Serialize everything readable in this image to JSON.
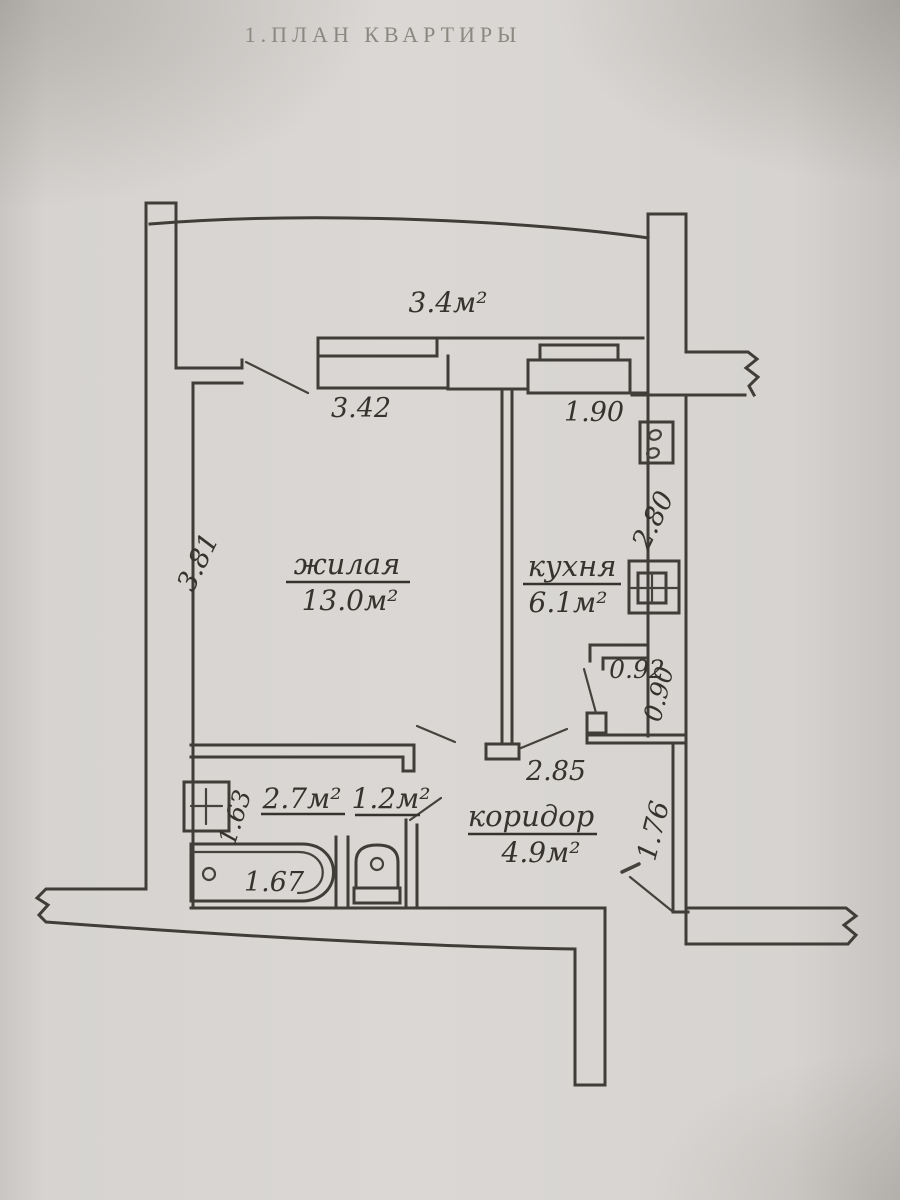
{
  "title": "1.ПЛАН КВАРТИРЫ",
  "balcony": {
    "area": "3.4м²"
  },
  "living": {
    "name": "жилая",
    "area": "13.0м²",
    "window_width": "3.42",
    "depth": "3.81"
  },
  "kitchen": {
    "name": "кухня",
    "area": "6.1м²",
    "window_width": "1.90",
    "depth": "2.80"
  },
  "corridor": {
    "name": "коридор",
    "area": "4.9м²",
    "length": "2.85",
    "entry_width": "1.76"
  },
  "bathroom": {
    "area": "2.7м²",
    "width": "1.63",
    "bath_length": "1.67"
  },
  "wc": {
    "area": "1.2м²"
  },
  "pantry": {
    "width": "0.92",
    "depth": "0.90"
  },
  "colors": {
    "ink": "#403c38",
    "paper": "#d7d4d1",
    "title_ink": "#8b8781"
  }
}
